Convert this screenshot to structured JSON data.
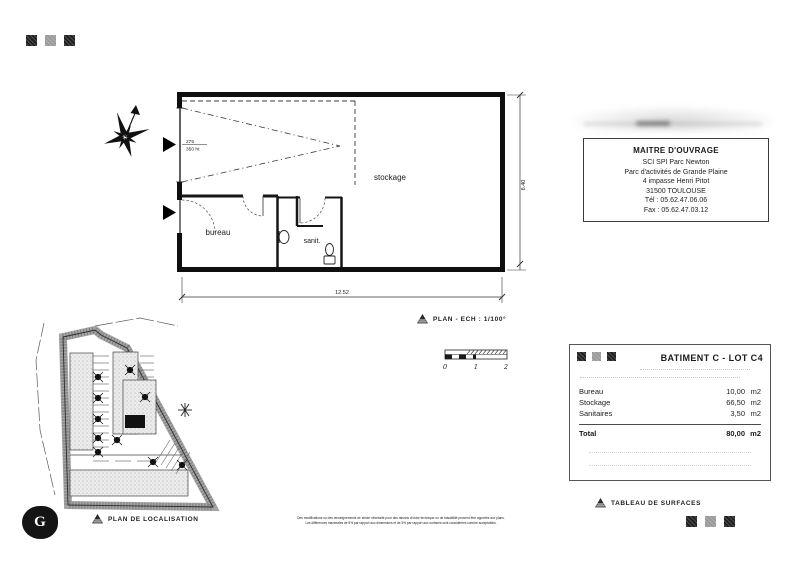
{
  "floor_plan": {
    "room_stockage": "stockage",
    "room_bureau": "bureau",
    "room_sanit": "sanit.",
    "door_dim_top": "275",
    "door_dim_bottom": "350 ht",
    "dim_width": "12.52",
    "dim_height": "6.40",
    "caption": "PLAN - ECH : 1/100°",
    "scale_labels": [
      "0",
      "1",
      "2"
    ]
  },
  "owner_box": {
    "title": "MAITRE D'OUVRAGE",
    "lines": [
      "SCI SPI Parc Newton",
      "Parc d'activités de Grande Plaine",
      "4 impasse Henri Pitot",
      "31500 TOULOUSE",
      "Tél : 05.62.47.06.06",
      "Fax : 05.62.47.03.12"
    ]
  },
  "surface_table": {
    "title": "BATIMENT C - LOT C4",
    "rows": [
      {
        "label": "Bureau",
        "value": "10,00",
        "unit": "m2"
      },
      {
        "label": "Stockage",
        "value": "66,50",
        "unit": "m2"
      },
      {
        "label": "Sanitaires",
        "value": "3,50",
        "unit": "m2"
      }
    ],
    "total": {
      "label": "Total",
      "value": "80,00",
      "unit": "m2"
    },
    "caption": "TABLEAU DE SURFACES"
  },
  "site_plan": {
    "caption": "PLAN DE LOCALISATION"
  },
  "logo_letter": "G",
  "disclaimer": {
    "line1": "Des modifications ou des renseignements de stricte nécessité pour des raisons d'ordre technique ou de faisabilité peuvent être apportés aux plans.",
    "line2": "Les différences maximales de 5% par rapport aux dimensions et de 3% par rapport aux surfaces sont considérées comme acceptables."
  },
  "colors": {
    "ink": "#1a1a1a",
    "paper": "#ffffff"
  }
}
